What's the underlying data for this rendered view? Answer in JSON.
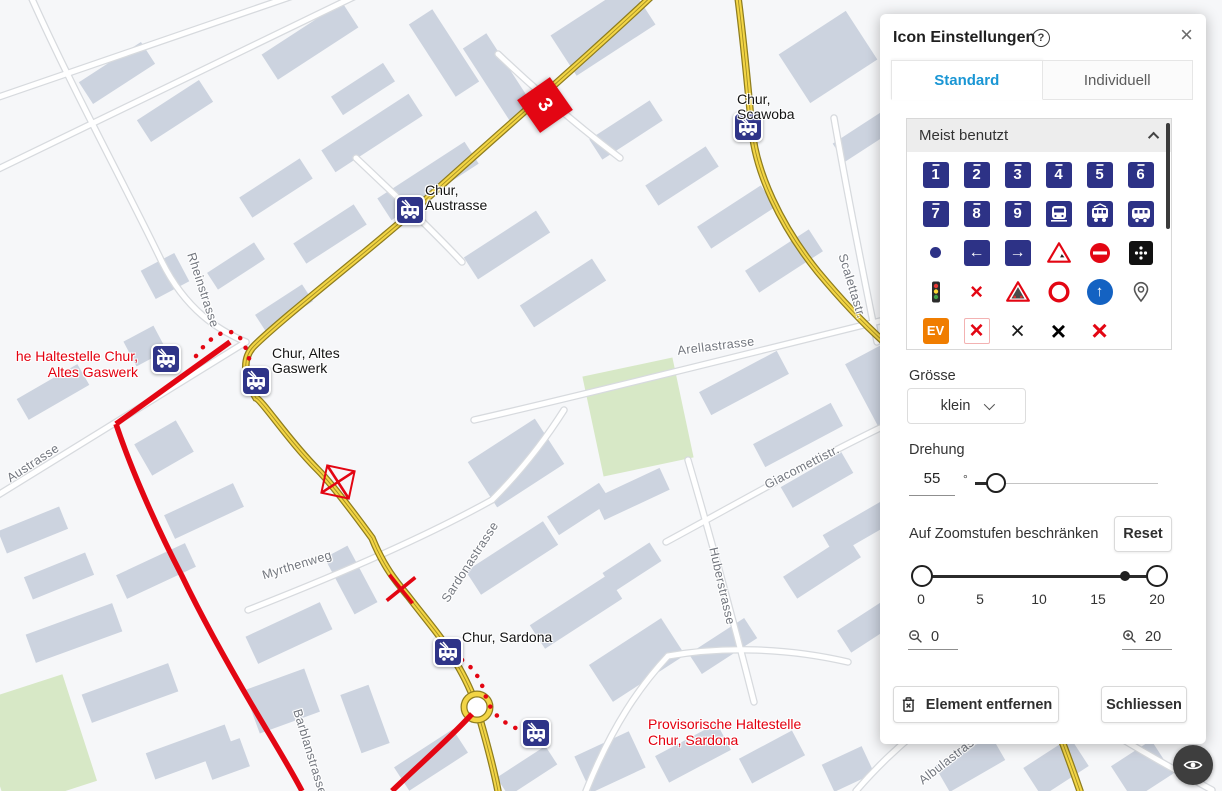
{
  "panel": {
    "title": "Icon Einstellungen",
    "help_icon": "?",
    "close_icon": "×",
    "tabs": {
      "standard": "Standard",
      "individuell": "Individuell"
    },
    "most_used": {
      "title": "Meist benutzt"
    },
    "icons": [
      {
        "name": "line-1",
        "glyph": "1"
      },
      {
        "name": "line-2",
        "glyph": "2"
      },
      {
        "name": "line-3",
        "glyph": "3"
      },
      {
        "name": "line-4",
        "glyph": "4"
      },
      {
        "name": "line-5",
        "glyph": "5"
      },
      {
        "name": "line-6",
        "glyph": "6"
      },
      {
        "name": "line-7",
        "glyph": "7"
      },
      {
        "name": "line-8",
        "glyph": "8"
      },
      {
        "name": "line-9",
        "glyph": "9"
      },
      {
        "name": "train",
        "glyph": ""
      },
      {
        "name": "tram",
        "glyph": ""
      },
      {
        "name": "bus",
        "glyph": ""
      },
      {
        "name": "stop-point",
        "glyph": ""
      },
      {
        "name": "arrow-left",
        "glyph": "←"
      },
      {
        "name": "arrow-right",
        "glyph": "→"
      },
      {
        "name": "construction-warning",
        "glyph": ""
      },
      {
        "name": "no-entry",
        "glyph": ""
      },
      {
        "name": "dots-sign",
        "glyph": ""
      },
      {
        "name": "traffic-light",
        "glyph": ""
      },
      {
        "name": "closed-crossing",
        "glyph": "×"
      },
      {
        "name": "rockfall-warning",
        "glyph": ""
      },
      {
        "name": "prohibition-ring",
        "glyph": ""
      },
      {
        "name": "mandatory-direction",
        "glyph": "↑"
      },
      {
        "name": "location-pin",
        "glyph": ""
      },
      {
        "name": "ev-replacement",
        "glyph": "EV"
      },
      {
        "name": "cancel-red-selected",
        "glyph": "×"
      },
      {
        "name": "cancel-black-thin",
        "glyph": "×"
      },
      {
        "name": "cancel-black-bold",
        "glyph": "×"
      },
      {
        "name": "cancel-red-bold",
        "glyph": "×"
      }
    ],
    "size": {
      "label": "Grösse",
      "value": "klein"
    },
    "rotation": {
      "label": "Drehung",
      "value": "55",
      "unit": "°"
    },
    "zoom_limit": {
      "label": "Auf Zoomstufen beschränken",
      "reset": "Reset",
      "ticks": [
        "0",
        "5",
        "10",
        "15",
        "20"
      ],
      "min": "0",
      "max": "20"
    },
    "actions": {
      "remove": "Element entfernen",
      "close": "Schliessen"
    }
  },
  "map": {
    "stops": [
      {
        "name": "chur-scawoba",
        "line1": "Chur,",
        "line2": "Scawoba"
      },
      {
        "name": "chur-austrasse",
        "line1": "Chur,",
        "line2": "Austrasse"
      },
      {
        "name": "chur-altes-gaswerk",
        "line1": "Chur, Altes",
        "line2": "Gaswerk"
      },
      {
        "name": "chur-sardona",
        "line1": "Chur, Sardona",
        "line2": ""
      }
    ],
    "notes": [
      {
        "name": "provisional-altes-gaswerk",
        "line1": "he Haltestelle Chur,",
        "line2": "Altes Gaswerk"
      },
      {
        "name": "provisional-sardona",
        "line1": "Provisorische Haltestelle",
        "line2": "Chur, Sardona"
      }
    ],
    "streets": [
      "Rheinstrasse",
      "Austrasse",
      "Myrthenweg",
      "Sardonastrasse",
      "Arellastrasse",
      "Giacomettistr.",
      "Huberstrasse",
      "Scalettastr.",
      "Barblanstrasse",
      "Albulastrasse"
    ],
    "selected_marker": {
      "label": "3",
      "rotation_deg": 55
    }
  }
}
